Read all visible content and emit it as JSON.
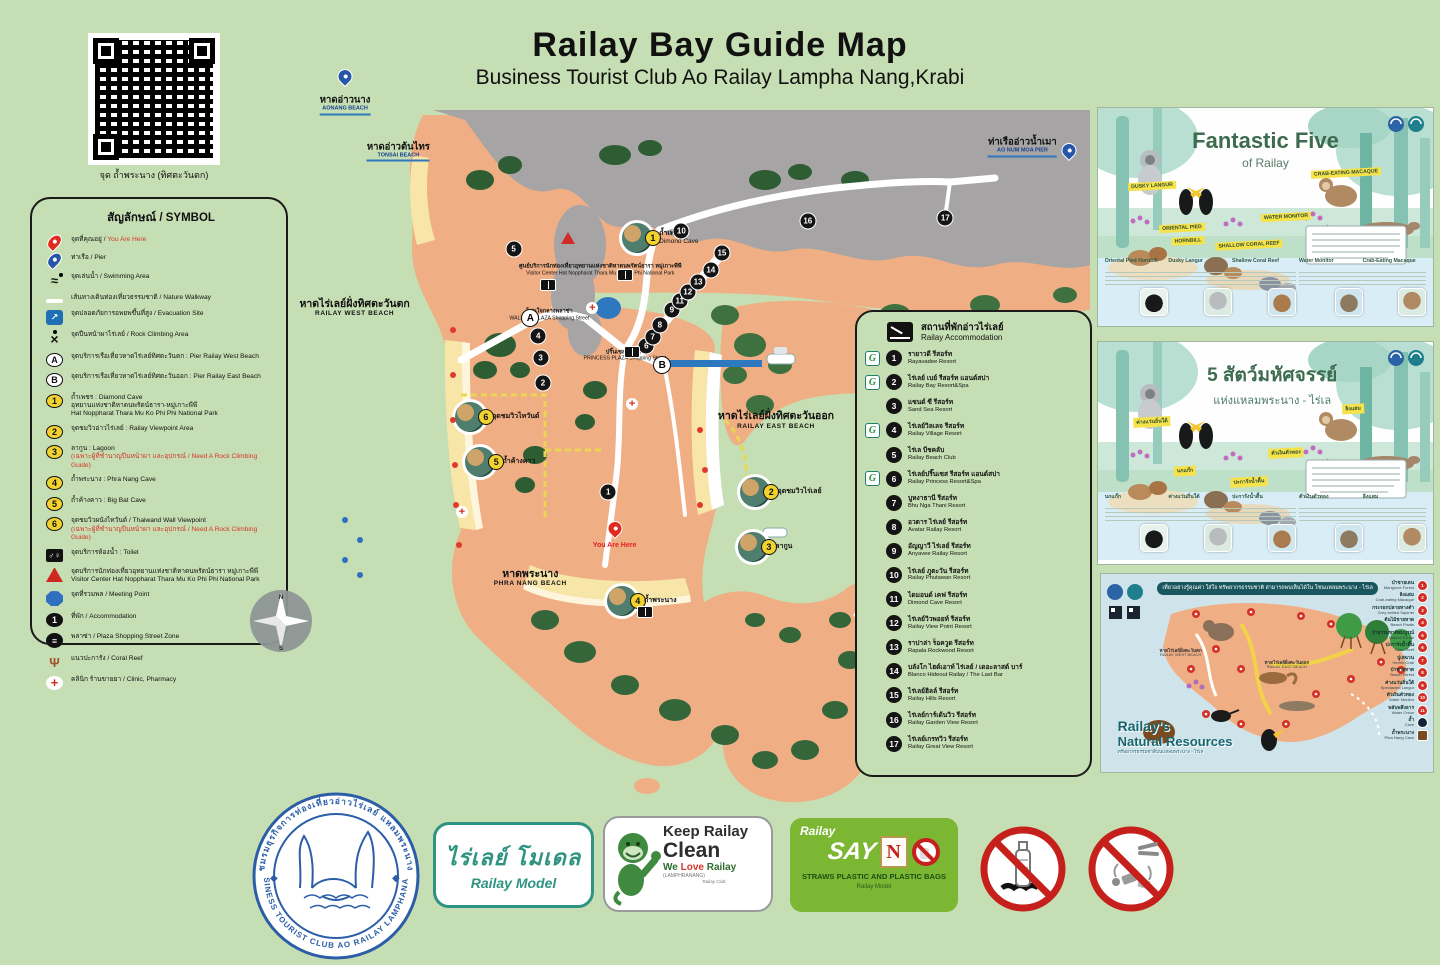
{
  "page": {
    "title": "Railay Bay Guide Map",
    "subtitle": "Business Tourist Club Ao Railay Lampha Nang,Krabi"
  },
  "qr": {
    "caption": "จุด ถ้ำพระนาง (ทิศตะวันตก)"
  },
  "legend": {
    "title": "สัญลักษณ์ / SYMBOL",
    "items": [
      {
        "icon": "pin-red",
        "badge": "",
        "th": "จุดที่คุณอยู่",
        "sep": " / ",
        "en": "You Are Here",
        "en_cls": "red",
        "sub": "",
        "note": ""
      },
      {
        "icon": "pin-blue",
        "badge": "",
        "th": "ท่าเรือ",
        "sep": " / ",
        "en": "Pier",
        "en_cls": "",
        "sub": "",
        "note": ""
      },
      {
        "icon": "swim",
        "badge": "",
        "th": "จุดเล่นน้ำ",
        "sep": " / ",
        "en": "Swimming Area",
        "en_cls": "",
        "sub": "",
        "note": ""
      },
      {
        "icon": "walkline",
        "badge": "",
        "th": "เส้นทางเดินท่องเที่ยวธรรมชาติ",
        "sep": " / ",
        "en": "Nature Walkway",
        "en_cls": "",
        "sub": "",
        "note": ""
      },
      {
        "icon": "evac",
        "badge": "",
        "th": "จุดปลอดภัยการอพยพขึ้นที่สูง",
        "sep": " / ",
        "en": "Evacuation Site",
        "en_cls": "",
        "sub": "",
        "note": ""
      },
      {
        "icon": "climb",
        "badge": "",
        "th": "จุดปีนหน้าผาไร่เลย์",
        "sep": " / ",
        "en": "Rock Climbing Area",
        "en_cls": "",
        "sub": "",
        "note": ""
      },
      {
        "icon": "wletter",
        "badge": "A",
        "th": "จุดบริการเรือเที่ยวหาดไร่เลย์ทิศตะวันตก",
        "sep": " : ",
        "en": "Pier Railay West Beach",
        "en_cls": "",
        "sub": "",
        "note": ""
      },
      {
        "icon": "wletter",
        "badge": "B",
        "th": "จุดบริการเรือเที่ยวหาดไร่เลย์ทิศตะวันออก",
        "sep": " : ",
        "en": "Pier Railay East Beach",
        "en_cls": "",
        "sub": "",
        "note": ""
      },
      {
        "icon": "yellow",
        "badge": "1",
        "th": "ถ้ำเพชร",
        "sep": " : ",
        "en": "Diamond Cave",
        "en_cls": "",
        "sub": "อุทยานแห่งชาติหาดนพรัตน์ธารา-หมู่เกาะพีพี\nHat Noppharat Thara Mu Ko Phi Phi National Park",
        "note": ""
      },
      {
        "icon": "yellow",
        "badge": "2",
        "th": "จุดชมวิวอ่าวไร่เลย์",
        "sep": " : ",
        "en": "Railay Viewpoint Area",
        "en_cls": "",
        "sub": "",
        "note": ""
      },
      {
        "icon": "yellow",
        "badge": "3",
        "th": "ลากูน",
        "sep": " : ",
        "en": "Lagoon",
        "en_cls": "",
        "sub": "",
        "note": "(เฉพาะผู้ที่ชำนาญปีนหน้าผา และอุปกรณ์ / Need A Rock Climbing Guide)"
      },
      {
        "icon": "yellow",
        "badge": "4",
        "th": "ถ้ำพระนาง",
        "sep": " : ",
        "en": "Phra Nang Cave",
        "en_cls": "",
        "sub": "",
        "note": ""
      },
      {
        "icon": "yellow",
        "badge": "5",
        "th": "ถ้ำค้างคาว",
        "sep": " : ",
        "en": "Big Bat Cave",
        "en_cls": "",
        "sub": "",
        "note": ""
      },
      {
        "icon": "yellow",
        "badge": "6",
        "th": "จุดชมวิวผนังไทวันด์",
        "sep": " / ",
        "en": "Thaiwand Wall Viewpoint",
        "en_cls": "",
        "sub": "",
        "note": "(เฉพาะผู้ที่ชำนาญปีนหน้าผา และอุปกรณ์ / Need A Rock Climbing Guide)"
      },
      {
        "icon": "toilet",
        "badge": "",
        "th": "จุดบริการห้องน้ำ",
        "sep": " : ",
        "en": "Toilet",
        "en_cls": "",
        "sub": "",
        "note": ""
      },
      {
        "icon": "tric",
        "badge": "",
        "th": "จุดบริการนักท่องเที่ยวอุทยานแห่งชาติหาดนพรัตน์ธารา หมู่เกาะพีพี",
        "sep": "",
        "en": "",
        "en_cls": "",
        "sub": "Visitor Center Hat Noppharat Thara Mu Ko Phi Phi National Park",
        "note": ""
      },
      {
        "icon": "oct",
        "badge": "",
        "th": "จุดที่รวมพล",
        "sep": " / ",
        "en": "Meeting Point",
        "en_cls": "",
        "sub": "",
        "note": ""
      },
      {
        "icon": "blkc",
        "badge": "1",
        "th": "ที่พัก",
        "sep": " / ",
        "en": "Accommodation",
        "en_cls": "",
        "sub": "",
        "note": ""
      },
      {
        "icon": "plaza",
        "badge": "",
        "th": "พลาซ่า",
        "sep": " / ",
        "en": "Plaza Shopping Street Zone",
        "en_cls": "",
        "sub": "",
        "note": ""
      },
      {
        "icon": "coral",
        "badge": "",
        "th": "แนวปะการัง",
        "sep": " / ",
        "en": "Coral Reef",
        "en_cls": "",
        "sub": "",
        "note": ""
      },
      {
        "icon": "clinic",
        "badge": "",
        "th": "คลินิก ร้านขายยา",
        "sep": " / ",
        "en": "Clinic, Pharmacy",
        "en_cls": "",
        "sub": "",
        "note": ""
      }
    ]
  },
  "map": {
    "labels": [
      {
        "cls": "pier",
        "x": 6.3,
        "y": 6.0,
        "th": "หาดอ่าวนาง",
        "en": "AONANG BEACH"
      },
      {
        "cls": "pier",
        "x": 13.0,
        "y": 12.2,
        "th": "หาดอ่าวต้นไทร",
        "en": "TONSAI BEACH"
      },
      {
        "cls": "pier",
        "x": 91.5,
        "y": 11.6,
        "th": "ท่าเรืออ่าวน้ำเมา",
        "en": "AO NUM MOA PIER"
      },
      {
        "cls": "beach",
        "x": 7.5,
        "y": 33.0,
        "th": "หาดไร่เลย์ฝั่งทิศตะวันตก",
        "en": "RAILAY WEST BEACH"
      },
      {
        "cls": "beach",
        "x": 60.5,
        "y": 48.0,
        "th": "หาดไร่เลย์ฝั่งทิศตะวันออก",
        "en": "RAILAY EAST BEACH"
      },
      {
        "cls": "beach",
        "x": 29.6,
        "y": 69.0,
        "th": "หาดพระนาง",
        "en": "PHRA NANG BEACH"
      },
      {
        "cls": "tiny",
        "x": 38.4,
        "y": 28.0,
        "th": "ศูนย์บริการนักท่องเที่ยวอุทยานแห่งชาติหาดนพรัตน์ธารา หมู่เกาะพีพี",
        "en": "Visitor Center Hat Noppharat Thara Mu Ko Phi Phi National Park"
      },
      {
        "cls": "tiny",
        "x": 32.0,
        "y": 34.0,
        "th": "โซนใจกลางพลาซ่า",
        "en": "WALKING PLAZA Shopping Street"
      },
      {
        "cls": "tiny",
        "x": 41.5,
        "y": 39.4,
        "th": "ปริ๊นเซส พลาซ่า",
        "en": "PRINCESS PLAZA Shopping Street"
      },
      {
        "cls": "here",
        "x": 40.2,
        "y": 64.8,
        "th": "",
        "en": "You Are Here"
      }
    ],
    "points": [
      {
        "k": "blk",
        "t": "1",
        "x": 39.4,
        "y": 57.6
      },
      {
        "k": "blk",
        "t": "2",
        "x": 31.2,
        "y": 43.1
      },
      {
        "k": "blk",
        "t": "3",
        "x": 30.9,
        "y": 39.7
      },
      {
        "k": "blk",
        "t": "4",
        "x": 30.6,
        "y": 36.8
      },
      {
        "k": "blk",
        "t": "5",
        "x": 27.5,
        "y": 25.2
      },
      {
        "k": "blk",
        "t": "6",
        "x": 44.2,
        "y": 38.1
      },
      {
        "k": "blk",
        "t": "7",
        "x": 45.0,
        "y": 36.9
      },
      {
        "k": "blk",
        "t": "8",
        "x": 45.9,
        "y": 35.3
      },
      {
        "k": "blk",
        "t": "9",
        "x": 47.4,
        "y": 33.3
      },
      {
        "k": "blk",
        "t": "10",
        "x": 48.6,
        "y": 22.8
      },
      {
        "k": "blk",
        "t": "11",
        "x": 48.4,
        "y": 32.1
      },
      {
        "k": "blk",
        "t": "12",
        "x": 49.4,
        "y": 30.9
      },
      {
        "k": "blk",
        "t": "13",
        "x": 50.7,
        "y": 29.6
      },
      {
        "k": "blk",
        "t": "14",
        "x": 52.3,
        "y": 28.0
      },
      {
        "k": "blk",
        "t": "15",
        "x": 53.7,
        "y": 25.7
      },
      {
        "k": "blk",
        "t": "16",
        "x": 64.5,
        "y": 21.5
      },
      {
        "k": "blk",
        "t": "17",
        "x": 81.8,
        "y": 21.1
      },
      {
        "k": "ltr",
        "t": "A",
        "x": 29.6,
        "y": 34.4
      },
      {
        "k": "ltr",
        "t": "B",
        "x": 46.2,
        "y": 40.7
      },
      {
        "k": "wc",
        "t": "",
        "x": 31.8,
        "y": 30.0
      },
      {
        "k": "wc",
        "t": "",
        "x": 41.5,
        "y": 27.1
      },
      {
        "k": "wc",
        "t": "",
        "x": 42.4,
        "y": 35.7
      },
      {
        "k": "wc",
        "t": "",
        "x": 44.0,
        "y": 68.8
      },
      {
        "k": "crs",
        "t": "",
        "x": 37.4,
        "y": 33.1
      },
      {
        "k": "crs",
        "t": "",
        "x": 42.4,
        "y": 45.9
      },
      {
        "k": "crs",
        "t": "",
        "x": 21.0,
        "y": 60.3
      },
      {
        "k": "tri",
        "t": "",
        "x": 34.3,
        "y": 23.7
      },
      {
        "k": "dot",
        "t": "",
        "x": 19.9,
        "y": 36.0
      },
      {
        "k": "dot",
        "t": "",
        "x": 19.9,
        "y": 42.0
      },
      {
        "k": "dot",
        "t": "",
        "x": 19.9,
        "y": 48.0
      },
      {
        "k": "dot",
        "t": "",
        "x": 20.1,
        "y": 54.0
      },
      {
        "k": "dot",
        "t": "",
        "x": 20.3,
        "y": 59.3
      },
      {
        "k": "dot",
        "t": "",
        "x": 20.6,
        "y": 64.7
      },
      {
        "k": "dot",
        "t": "",
        "x": 50.9,
        "y": 49.3
      },
      {
        "k": "dot",
        "t": "",
        "x": 51.6,
        "y": 54.7
      },
      {
        "k": "dot",
        "t": "",
        "x": 50.9,
        "y": 59.3
      },
      {
        "k": "bdot",
        "t": "",
        "x": 6.3,
        "y": 61.3
      },
      {
        "k": "bdot",
        "t": "",
        "x": 8.2,
        "y": 64.0
      },
      {
        "k": "bdot",
        "t": "",
        "x": 6.3,
        "y": 66.7
      },
      {
        "k": "bdot",
        "t": "",
        "x": 8.2,
        "y": 68.7
      },
      {
        "k": "pin",
        "t": "",
        "x": 40.2,
        "y": 63.5
      },
      {
        "k": "bluepin",
        "t": "",
        "x": 6.3,
        "y": 3.2
      },
      {
        "k": "bluepin",
        "t": "",
        "x": 97.3,
        "y": 13.0
      }
    ],
    "photos": [
      {
        "n": "1",
        "x": 43.0,
        "y": 23.7,
        "th": "ถ้ำเพชร",
        "en": "Dimond Cave"
      },
      {
        "n": "6",
        "x": 22.0,
        "y": 47.6,
        "th": "จุดชมวิวไทวันด์",
        "en": ""
      },
      {
        "n": "5",
        "x": 23.3,
        "y": 53.6,
        "th": "ถ้ำค้างคาว",
        "en": ""
      },
      {
        "n": "2",
        "x": 57.9,
        "y": 57.6,
        "th": "จุดชมวิวไร่เลย์",
        "en": ""
      },
      {
        "n": "3",
        "x": 57.6,
        "y": 64.9,
        "th": "ลากูน",
        "en": ""
      },
      {
        "n": "4",
        "x": 41.1,
        "y": 72.1,
        "th": "ถ้ำพระนาง",
        "en": ""
      }
    ]
  },
  "accommodation": {
    "title_th": "สถานที่พักอ่าวไร่เลย์",
    "title_en": "Railay Accommodation",
    "items": [
      {
        "n": "1",
        "g": "G",
        "th": "รายาวดี รีสอร์ท",
        "en": "Rayavadee Resort"
      },
      {
        "n": "2",
        "g": "G",
        "th": "ไร่เลย์ เบย์ รีสอร์ท แอนด์สปา",
        "en": "Railay Bay Resort&Spa"
      },
      {
        "n": "3",
        "g": "",
        "th": "แซนด์ ซี รีสอร์ท",
        "en": "Sand Sea Resort"
      },
      {
        "n": "4",
        "g": "G",
        "th": "ไร่เลย์วิลเลจ รีสอร์ท",
        "en": "Railay Village Resort"
      },
      {
        "n": "5",
        "g": "",
        "th": "ไร่เล บีชคลับ",
        "en": "Railay Beach Club"
      },
      {
        "n": "6",
        "g": "G",
        "th": "ไร่เลย์ปริ๊นเซส รีสอร์ท แอนด์สปา",
        "en": "Railay Princess Resort&Spa"
      },
      {
        "n": "7",
        "g": "",
        "th": "บูหงาธานี รีสอร์ท",
        "en": "Bhu Nga Thani Resort"
      },
      {
        "n": "8",
        "g": "",
        "th": "อวตาร ไร่เลย์ รีสอร์ท",
        "en": "Avatar Railay Resort"
      },
      {
        "n": "9",
        "g": "",
        "th": "อัญญาวี ไร่เลย์ รีสอร์ท",
        "en": "Anyavee Railay Resort"
      },
      {
        "n": "10",
        "g": "",
        "th": "ไร่เลย์ ภูตะวัน รีสอร์ท",
        "en": "Railay Phutawan Resort"
      },
      {
        "n": "11",
        "g": "",
        "th": "ไดมอนด์ เคฟ รีสอร์ท",
        "en": "Dimond Cave Resort"
      },
      {
        "n": "12",
        "g": "",
        "th": "ไร่เลย์วิวพอยท์ รีสอร์ท",
        "en": "Railay View Point Resort"
      },
      {
        "n": "13",
        "g": "",
        "th": "ราปาล่า ร็อควูด รีสอร์ท",
        "en": "Rapala Rockwood Resort"
      },
      {
        "n": "14",
        "g": "",
        "th": "บลังโก ไฮด์เอาท์ ไร่เลย์ / เดอะลาสต์ บาร์",
        "en": "Blanco Hideout Railay / The Last Bar"
      },
      {
        "n": "15",
        "g": "",
        "th": "ไร่เลย์ฮิลล์ รีสอร์ท",
        "en": "Railay Hills Resort"
      },
      {
        "n": "16",
        "g": "",
        "th": "ไร่เลย์การ์เด้นวิว รีสอร์ท",
        "en": "Railay Garden View Resort"
      },
      {
        "n": "17",
        "g": "",
        "th": "ไร่เลย์เกรทวิว รีสอร์ท",
        "en": "Railay Great View Resort"
      }
    ]
  },
  "posters": {
    "five_en": {
      "title": "Fantastic Five",
      "subtitle": "of Railay",
      "tags": [
        {
          "t": "DUSKY LANGUR",
          "x": 16,
          "y": 36
        },
        {
          "t": "ORIENTAL PIED",
          "x": 25,
          "y": 55
        },
        {
          "t": "HORNBILL",
          "x": 27,
          "y": 61
        },
        {
          "t": "CRAB-EATING MACAQUE",
          "x": 74,
          "y": 30
        },
        {
          "t": "WATER MONITOR",
          "x": 56,
          "y": 50
        },
        {
          "t": "SHALLOW CORAL REEF",
          "x": 45,
          "y": 63
        }
      ],
      "cards": [
        {
          "name": "Oriental Pied Hornbill",
          "x": 2,
          "thumb": "th-bird"
        },
        {
          "name": "Dusky Langur",
          "x": 21,
          "thumb": "th-langur"
        },
        {
          "name": "Shallow Coral Reef",
          "x": 40,
          "thumb": "th-coral"
        },
        {
          "name": "Water Monitor",
          "x": 60,
          "thumb": "th-monitor"
        },
        {
          "name": "Crab-Eating Macaque",
          "x": 79,
          "thumb": "th-macaque"
        }
      ]
    },
    "five_th": {
      "title": "5 สัตว์มหัศจรรย์",
      "subtitle": "แห่งแหลมพระนาง - ไร่เล",
      "tags": [
        {
          "t": "ค่างแว่นถิ่นใต้",
          "x": 16,
          "y": 36
        },
        {
          "t": "นกแก๊ก",
          "x": 26,
          "y": 58
        },
        {
          "t": "ลิงแสม",
          "x": 76,
          "y": 30
        },
        {
          "t": "ตัวเงินตัวทอง",
          "x": 56,
          "y": 50
        },
        {
          "t": "ปะการังน้ำตื้น",
          "x": 45,
          "y": 63
        }
      ],
      "cards": [
        {
          "name": "นกแก๊ก",
          "x": 2,
          "thumb": "th-bird"
        },
        {
          "name": "ค่างแว่นถิ่นใต้",
          "x": 21,
          "thumb": "th-langur"
        },
        {
          "name": "ปะการังน้ำตื้น",
          "x": 40,
          "thumb": "th-coral"
        },
        {
          "name": "ตัวเงินตัวทอง",
          "x": 60,
          "thumb": "th-monitor"
        },
        {
          "name": "ลิงแสม",
          "x": 79,
          "thumb": "th-macaque"
        }
      ]
    },
    "resources": {
      "banner": "เที่ยวอย่างรู้คุณค่า ใส่ใจ ทรัพยากรธรรมชาติ สามารถพบเห็นได้ใน โซนแหลมพระนาง - ไร่เล",
      "title1": "Railay's",
      "title2": "Natural Resources",
      "subtitle_th": "ทรัพยากรธรรมชาติบนแหลมพระนาง - ไร่เล",
      "west_th": "หาดไร่เลย์ฝั่งตะวันตก",
      "west_en": "RAILAY WEST BEACH",
      "east_th": "หาดไร่เลย์ฝั่งตะวันออก",
      "east_en": "RAILAY EAST BEACH",
      "items": [
        {
          "n": "1",
          "k": "rp",
          "th": "ป่าชายเลน",
          "en": "Mangrove Forest"
        },
        {
          "n": "2",
          "k": "rp",
          "th": "ลิงแสม",
          "en": "Crab-eating Macaque"
        },
        {
          "n": "3",
          "k": "rp",
          "th": "กระรอกปลายหางดำ",
          "en": "Grey-bellied Squirrel"
        },
        {
          "n": "4",
          "k": "rp",
          "th": "ต้นไม้ชายหาด",
          "en": "Beach Plants"
        },
        {
          "n": "5",
          "k": "rp",
          "th": "ป่าธรรมชาติสมบูรณ์",
          "en": "Natural Forest"
        },
        {
          "n": "6",
          "k": "rp",
          "th": "ปะการังน้ำตื้น",
          "en": "Coral Reef"
        },
        {
          "n": "7",
          "k": "rp",
          "th": "ปูเสฉวน",
          "en": "Hermit Crab"
        },
        {
          "n": "8",
          "k": "rp",
          "th": "ป่าชายหาด",
          "en": "Beach Forest"
        },
        {
          "n": "9",
          "k": "rp",
          "th": "ค่างแว่นถิ่นใต้",
          "en": "Spectacled Langur"
        },
        {
          "n": "10",
          "k": "rp",
          "th": "ตัวเงินตัวทอง",
          "en": "Water Monitor"
        },
        {
          "n": "11",
          "k": "rp",
          "th": "พลับพลึงธาร",
          "en": "Water Onion"
        },
        {
          "n": "",
          "k": "bp",
          "th": "ถ้ำ",
          "en": "Cave"
        },
        {
          "n": "",
          "k": "br",
          "th": "ถ้ำพระนาง",
          "en": "Phra Nang Cave"
        }
      ]
    }
  },
  "footer": {
    "seal": {
      "arc_top": "ชมรมธุรกิจการท่องเที่ยวอ่าวไร่เลย์ แหลมพระนาง",
      "arc_bottom": "BUSINESS TOURIST CLUB AO RAILAY LAMPHANANG"
    },
    "model": {
      "th": "ไร่เลย์ โมเดล",
      "en": "Railay Model"
    },
    "clean": {
      "l1": "Keep Railay",
      "l2": "Clean",
      "l3a": "We ",
      "l3b": "Love",
      "l3c": " Railay",
      "l4": "(LAMPHRANANG)",
      "l5": "Railay Club"
    },
    "sayno": {
      "brand": "Railay",
      "say": "SAY",
      "n": "N",
      "line": "STRAWS PLASTIC AND PLASTIC BAGS",
      "sub": "Railay Model"
    }
  },
  "colors": {
    "background": "#c6deb3",
    "land": "#f0ae84",
    "cliff": "#a7a4a5",
    "beach": "#f8e6a8",
    "sea_pier": "#2e78bf",
    "accent_green": "#7cb733",
    "prohibit_red": "#c6201d",
    "seal_blue": "#2b5ea7",
    "model_teal": "#2f9382"
  }
}
